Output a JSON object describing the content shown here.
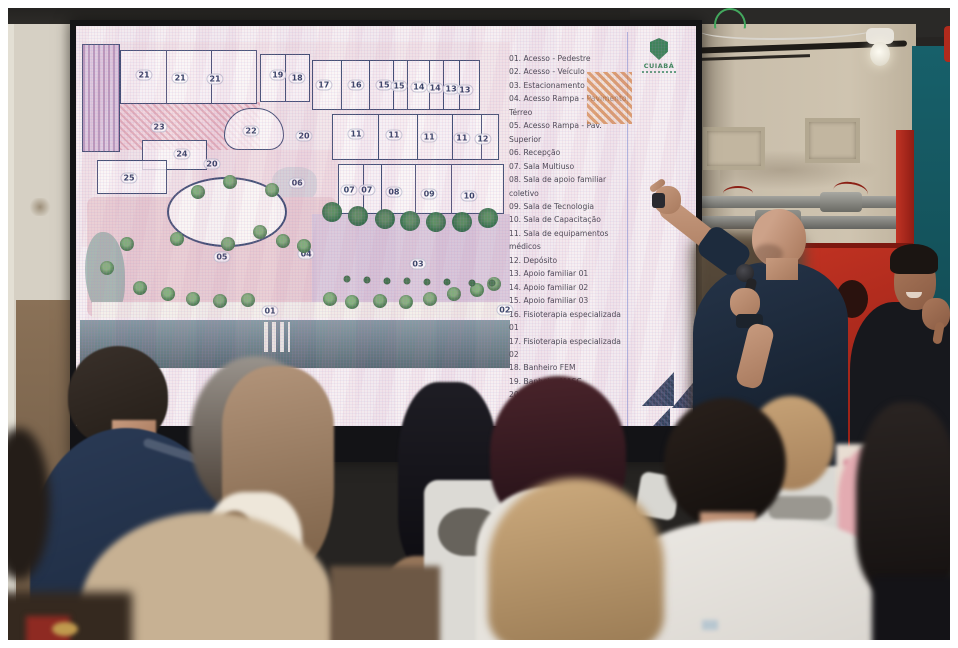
{
  "colors": {
    "logo-green": "#2e7d4f",
    "plan-wall": "#3c4a70",
    "hatch-orange": "#dd9350",
    "cabinet-red": "#a8241c",
    "door-teal": "#155a63",
    "accent-navy": "#2b3a55"
  },
  "screen": {
    "slide": {
      "partial_title": "e",
      "logo": {
        "text": "CUIABÁ"
      },
      "legend": {
        "items": [
          "01. Acesso - Pedestre",
          "02. Acesso - Veículo",
          "03. Estacionamento",
          "04. Acesso Rampa - Pavimento Térreo",
          "05. Acesso Rampa - Pav. Superior",
          "06. Recepção",
          "07. Sala Multiuso",
          "08. Sala de apoio familiar coletivo",
          "09. Sala de Tecnologia",
          "10. Sala de Capacitação",
          "11. Sala de equipamentos médicos",
          "12. Depósito",
          "13. Apoio familiar 01",
          "14. Apoio familiar 02",
          "15. Apoio familiar 03",
          "16. Fisioterapia especializada 01",
          "17. Fisioterapia especializada 02",
          "18. Banheiro FEM",
          "19. Banheiro MASC",
          "20. Pátio recreativo",
          "21. Sala das Associações",
          "22. Escada principal",
          "23. Pátio refeitório",
          "24. Lanchonete",
          "25. Co"
        ]
      },
      "plan": {
        "room_labels": [
          {
            "label": "21",
            "x": 14.9,
            "y": 12.8
          },
          {
            "label": "21",
            "x": 23.3,
            "y": 13.7
          },
          {
            "label": "21",
            "x": 31.4,
            "y": 14.0
          },
          {
            "label": "19",
            "x": 46.0,
            "y": 12.8
          },
          {
            "label": "18",
            "x": 50.5,
            "y": 13.7
          },
          {
            "label": "17",
            "x": 56.7,
            "y": 15.8
          },
          {
            "label": "16",
            "x": 64.2,
            "y": 15.8
          },
          {
            "label": "15",
            "x": 70.7,
            "y": 15.8
          },
          {
            "label": "15",
            "x": 74.2,
            "y": 16.1
          },
          {
            "label": "14",
            "x": 78.8,
            "y": 16.4
          },
          {
            "label": "14",
            "x": 82.6,
            "y": 16.7
          },
          {
            "label": "13",
            "x": 86.3,
            "y": 17.0
          },
          {
            "label": "13",
            "x": 89.5,
            "y": 17.3
          },
          {
            "label": "23",
            "x": 18.4,
            "y": 28.3
          },
          {
            "label": "22",
            "x": 39.8,
            "y": 29.5
          },
          {
            "label": "24",
            "x": 23.7,
            "y": 36.3
          },
          {
            "label": "20",
            "x": 30.7,
            "y": 39.3
          },
          {
            "label": "25",
            "x": 11.4,
            "y": 43.5
          },
          {
            "label": "20",
            "x": 52.1,
            "y": 31.0
          },
          {
            "label": "11",
            "x": 64.2,
            "y": 30.4
          },
          {
            "label": "11",
            "x": 73.0,
            "y": 30.7
          },
          {
            "label": "11",
            "x": 81.2,
            "y": 31.3
          },
          {
            "label": "11",
            "x": 88.8,
            "y": 31.5
          },
          {
            "label": "12",
            "x": 93.7,
            "y": 31.8
          },
          {
            "label": "06",
            "x": 50.5,
            "y": 44.9
          },
          {
            "label": "07",
            "x": 62.6,
            "y": 47.0
          },
          {
            "label": "07",
            "x": 66.7,
            "y": 47.0
          },
          {
            "label": "08",
            "x": 73.0,
            "y": 47.6
          },
          {
            "label": "09",
            "x": 81.2,
            "y": 48.2
          },
          {
            "label": "10",
            "x": 90.5,
            "y": 48.8
          },
          {
            "label": "05",
            "x": 33.0,
            "y": 67.0
          },
          {
            "label": "04",
            "x": 52.6,
            "y": 66.1
          },
          {
            "label": "03",
            "x": 78.6,
            "y": 69.0
          },
          {
            "label": "01",
            "x": 44.2,
            "y": 83.0
          },
          {
            "label": "02",
            "x": 98.8,
            "y": 82.7
          }
        ]
      }
    }
  }
}
